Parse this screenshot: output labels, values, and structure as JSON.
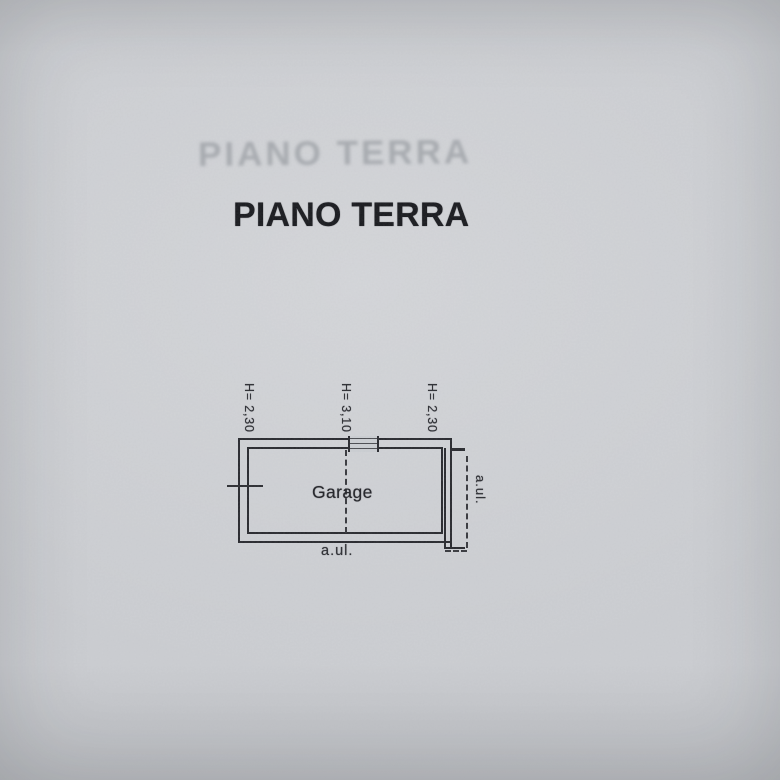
{
  "document": {
    "ghost_title": "PIANO TERRA",
    "title": "PIANO TERRA"
  },
  "plan": {
    "room_label": "Garage",
    "height_labels": [
      "H= 2,30",
      "H= 3,10",
      "H= 2,30"
    ],
    "exterior_label_bottom": "a.ul.",
    "exterior_label_right": "a.ul."
  },
  "colors": {
    "paper": "#ccced2",
    "ink": "#27282d",
    "title_ink": "#17181c",
    "ghost_ink": "#82878d"
  }
}
